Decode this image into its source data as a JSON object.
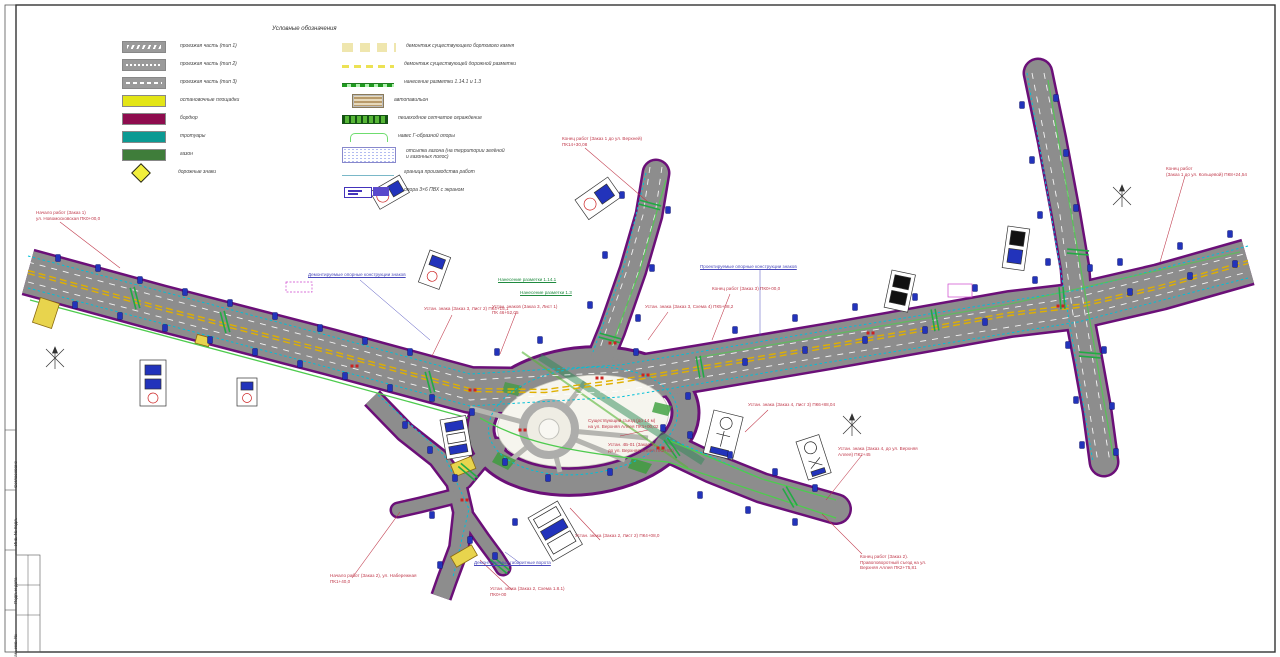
{
  "legend": {
    "title": "Условные обозначения",
    "left": [
      {
        "swatch": "gray-zig",
        "label": "проезжая часть (тип 1)"
      },
      {
        "swatch": "gray-dots",
        "label": "проезжая часть (тип 2)"
      },
      {
        "swatch": "gray-dash",
        "label": "проезжая часть (тип 3)"
      },
      {
        "swatch": "yellow",
        "label": "остановочные площадки"
      },
      {
        "swatch": "maroon",
        "label": "бордюр"
      },
      {
        "swatch": "teal",
        "label": "тротуары"
      },
      {
        "swatch": "green",
        "label": "газон"
      },
      {
        "swatch": "diamond",
        "label": "дорожные знаки"
      }
    ],
    "right": [
      {
        "symbol": "tandash",
        "label": "демонтаж существующего бортового камня"
      },
      {
        "symbol": "yeldash",
        "label": "демонтаж существующей дорожной разметки"
      },
      {
        "symbol": "greenline",
        "label": "нанесение разметки 1.14.1 и 1.3"
      },
      {
        "symbol": "shelter",
        "label": "автопавильон"
      },
      {
        "symbol": "greenbar",
        "label": "пешеходное сетчатое ограждение"
      },
      {
        "symbol": "bracket",
        "label": "навес Г-образной опоры"
      },
      {
        "symbol": "dotbox",
        "label": "отсыпка газона (на территории зелёной\nи газонных полос)"
      },
      {
        "symbol": "thinline",
        "label": "граница производства работ"
      },
      {
        "symbol": "screens",
        "label": "опора 3×6 ПВХ с экраном"
      }
    ]
  },
  "annotations": {
    "red": [
      {
        "x": 36,
        "y": 210,
        "text": "Начало работ (Заказ 1)\nул. Новомосковская ПК0+00,0"
      },
      {
        "x": 562,
        "y": 136,
        "text": "Конец работ (Заказ 1 до ул. Верхней)\nПК14+30,08"
      },
      {
        "x": 1166,
        "y": 166,
        "text": "Конец работ\n(Заказ 1 до ул. Кольцевой) ПК8+24,54"
      },
      {
        "x": 424,
        "y": 306,
        "text": "Устан. знака (Заказ 3, Лист 2) ПК4+15,1"
      },
      {
        "x": 492,
        "y": 304,
        "text": "Устан. знаков (Заказ 3, Лист 1)\nПК 46+52,05"
      },
      {
        "x": 645,
        "y": 304,
        "text": "Устан. знака (Заказ 3, Схема 4) ПК5+08,2"
      },
      {
        "x": 712,
        "y": 286,
        "text": "Конец работ (Заказ 3) ПК0+00,0"
      },
      {
        "x": 748,
        "y": 402,
        "text": "Устан. знака (Заказ 4, Лист 3) ПК6+88,04"
      },
      {
        "x": 838,
        "y": 446,
        "text": "Устан. знака (Заказ 4, до ул. Верхняя\nАллея) ПК2+45"
      },
      {
        "x": 860,
        "y": 554,
        "text": "Конец работ (Заказ 2).\nПравоповоротный съезд на ул.\nВерхняя Аллея ПК2+75,81"
      },
      {
        "x": 575,
        "y": 533,
        "text": "Устан. знака (Заказ 2, Лист 2) ПК4+08,0"
      },
      {
        "x": 330,
        "y": 573,
        "text": "Начало работ (Заказ 2), ул. Набережная\nПК1+40,0"
      },
      {
        "x": 490,
        "y": 586,
        "text": "Устан. знака (Заказ 2, Схема 1.8.1)\nПК0+00"
      },
      {
        "x": 588,
        "y": 418,
        "text": "Существующий съезд (до 14 м)\nна ул. Верхняя Аллея ПК1+00,02"
      },
      {
        "x": 608,
        "y": 442,
        "text": "Устан. 4Б-01 (Заказ 1,\nдо ул. Верхняя Аллея ПК2+85)"
      }
    ],
    "blue": [
      {
        "x": 308,
        "y": 272,
        "text": "Демонтируемые опорные конструкции знаков"
      },
      {
        "x": 700,
        "y": 264,
        "text": "Проектируемые опорные конструкции знаков"
      },
      {
        "x": 474,
        "y": 560,
        "text": "Демонтируемые габаритные ворота"
      }
    ],
    "green": [
      {
        "x": 498,
        "y": 277,
        "text": "Нанесение разметки 1.14.1"
      },
      {
        "x": 520,
        "y": 290,
        "text": "Нанесение разметки 1.3"
      }
    ]
  },
  "titleblock": {
    "rows": [
      "Согласовано",
      "Инв. № подл.",
      "Подп. и дата",
      "Взам. инв. №"
    ]
  },
  "colors": {
    "curb": "#6b0f78",
    "asphalt": "#8d8d8d",
    "center_line": "#e0b000",
    "lane_cyan": "#00c0d8",
    "marking_green": "#22aa44",
    "sign_blue": "#2233bb",
    "annotation_red": "#c0394b",
    "island_fill": "#f6f5ee"
  },
  "drawing": {
    "markers": [
      [
        58,
        258
      ],
      [
        98,
        268
      ],
      [
        140,
        280
      ],
      [
        185,
        292
      ],
      [
        230,
        303
      ],
      [
        275,
        316
      ],
      [
        320,
        328
      ],
      [
        365,
        341
      ],
      [
        410,
        352
      ],
      [
        75,
        305
      ],
      [
        120,
        316
      ],
      [
        165,
        328
      ],
      [
        210,
        340
      ],
      [
        255,
        352
      ],
      [
        300,
        364
      ],
      [
        345,
        376
      ],
      [
        390,
        388
      ],
      [
        432,
        398
      ],
      [
        622,
        195
      ],
      [
        668,
        210
      ],
      [
        605,
        255
      ],
      [
        652,
        268
      ],
      [
        590,
        305
      ],
      [
        638,
        318
      ],
      [
        735,
        330
      ],
      [
        795,
        318
      ],
      [
        855,
        307
      ],
      [
        915,
        297
      ],
      [
        975,
        288
      ],
      [
        1035,
        280
      ],
      [
        745,
        362
      ],
      [
        805,
        350
      ],
      [
        865,
        340
      ],
      [
        925,
        330
      ],
      [
        985,
        322
      ],
      [
        1120,
        262
      ],
      [
        1180,
        246
      ],
      [
        1230,
        234
      ],
      [
        1130,
        292
      ],
      [
        1190,
        276
      ],
      [
        1235,
        264
      ],
      [
        1022,
        105
      ],
      [
        1056,
        98
      ],
      [
        1032,
        160
      ],
      [
        1066,
        153
      ],
      [
        1040,
        215
      ],
      [
        1076,
        208
      ],
      [
        1048,
        262
      ],
      [
        1090,
        268
      ],
      [
        1068,
        345
      ],
      [
        1104,
        350
      ],
      [
        1076,
        400
      ],
      [
        1112,
        406
      ],
      [
        1082,
        445
      ],
      [
        1116,
        452
      ],
      [
        405,
        425
      ],
      [
        430,
        450
      ],
      [
        455,
        478
      ],
      [
        432,
        515
      ],
      [
        470,
        540
      ],
      [
        495,
        556
      ],
      [
        515,
        522
      ],
      [
        440,
        565
      ],
      [
        690,
        435
      ],
      [
        730,
        455
      ],
      [
        775,
        472
      ],
      [
        815,
        488
      ],
      [
        700,
        495
      ],
      [
        748,
        510
      ],
      [
        795,
        522
      ],
      [
        497,
        352
      ],
      [
        472,
        412
      ],
      [
        505,
        462
      ],
      [
        548,
        478
      ],
      [
        610,
        472
      ],
      [
        663,
        428
      ],
      [
        688,
        396
      ],
      [
        540,
        340
      ],
      [
        636,
        352
      ]
    ],
    "crosswalks": [
      [
        135,
        298,
        75
      ],
      [
        225,
        322,
        75
      ],
      [
        430,
        382,
        75
      ],
      [
        610,
        338,
        15
      ],
      [
        650,
        205,
        15
      ],
      [
        700,
        367,
        80
      ],
      [
        935,
        320,
        80
      ],
      [
        1062,
        298,
        85
      ],
      [
        1078,
        252,
        5
      ],
      [
        1090,
        355,
        5
      ],
      [
        468,
        472,
        40
      ],
      [
        672,
        448,
        55
      ],
      [
        790,
        497,
        60
      ],
      [
        500,
        565,
        40
      ]
    ],
    "redticks": [
      [
        352,
        366
      ],
      [
        470,
        390
      ],
      [
        597,
        378
      ],
      [
        643,
        375
      ],
      [
        868,
        333
      ],
      [
        1058,
        306
      ],
      [
        610,
        343
      ],
      [
        658,
        448
      ],
      [
        462,
        500
      ],
      [
        520,
        430
      ]
    ]
  }
}
